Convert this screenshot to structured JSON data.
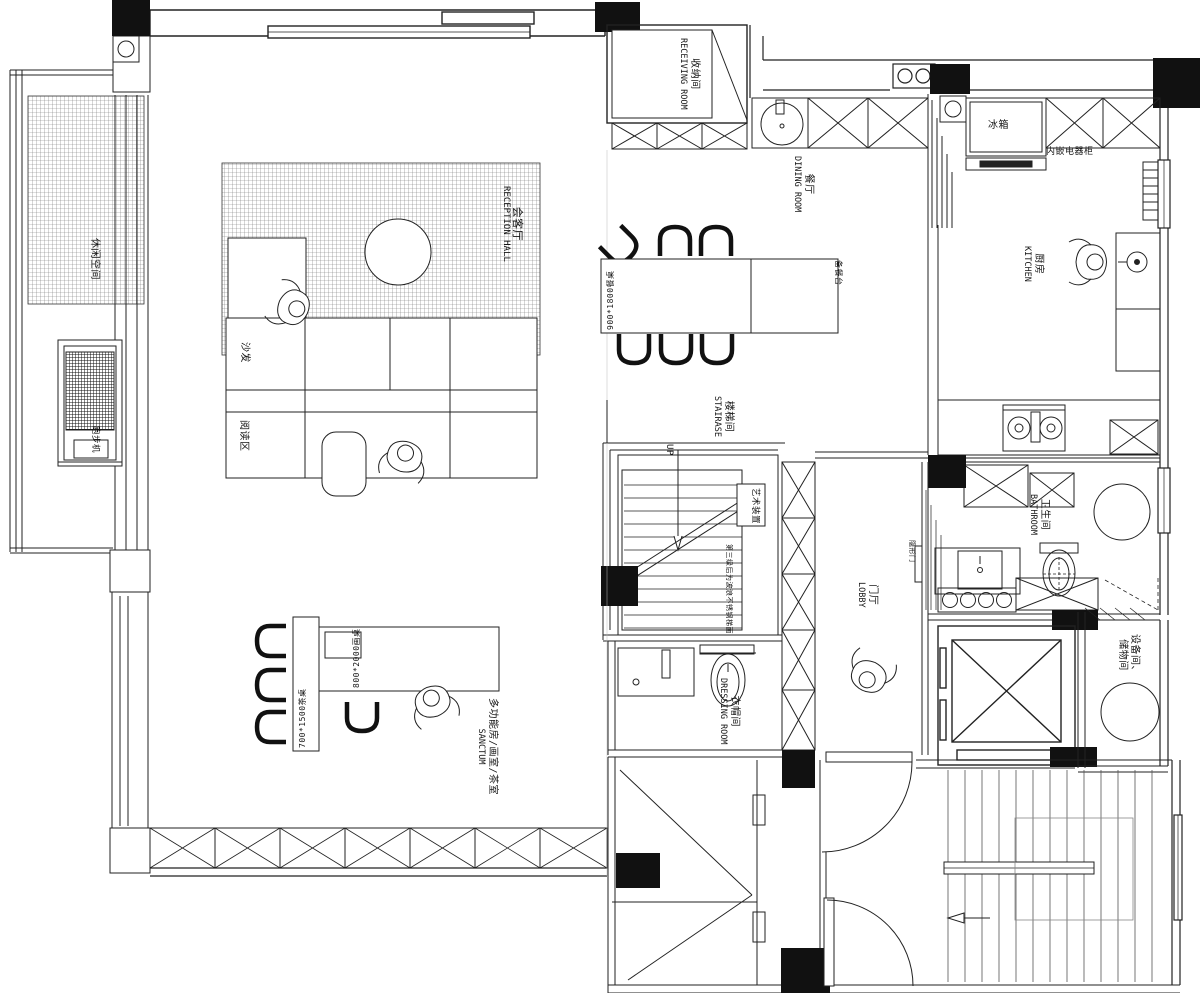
{
  "plan": {
    "rooms": {
      "reception_hall": {
        "zh": "会客厅",
        "en": "RECEPTION HALL"
      },
      "receiving_room": {
        "zh": "收纳间",
        "en": "RECEIVING ROOM"
      },
      "dining_room": {
        "zh": "餐厅",
        "en": "DINING ROOM"
      },
      "kitchen": {
        "zh": "厨房",
        "en": "KITCHEN"
      },
      "staircase": {
        "zh": "楼梯间",
        "en": "STAIRASE"
      },
      "bathroom": {
        "zh": "卫生间",
        "en": "BATHROOM"
      },
      "lobby": {
        "zh": "门厅",
        "en": "LOBBY"
      },
      "dressing_room": {
        "zh": "衣帽间",
        "en": "DRESSING ROOM"
      },
      "sanctum": {
        "zh": "多功能房/画室/茶室",
        "en": "SANCTUM"
      },
      "equipment_storage": {
        "zh_line1": "设备间、",
        "zh_line2": "储物间"
      },
      "leisure_space": {
        "zh": "休闲空间"
      }
    },
    "furniture": {
      "sofa": "沙发",
      "reading_area": "阅读区",
      "treadmill": "跑步机",
      "fridge": "冰箱",
      "appliance_cabinet": "内嵌电器柜",
      "art_installation": "艺术装置",
      "serving_counter": "备餐台",
      "dining_table": "900*1800餐桌",
      "tea_table": "700*1500茶桌",
      "painting_table": "800*2000画桌"
    },
    "annotations": {
      "up": "UP",
      "hidden_door": "隐形门",
      "stair_note": "第三级后为波浪不锈钢梯面"
    }
  }
}
